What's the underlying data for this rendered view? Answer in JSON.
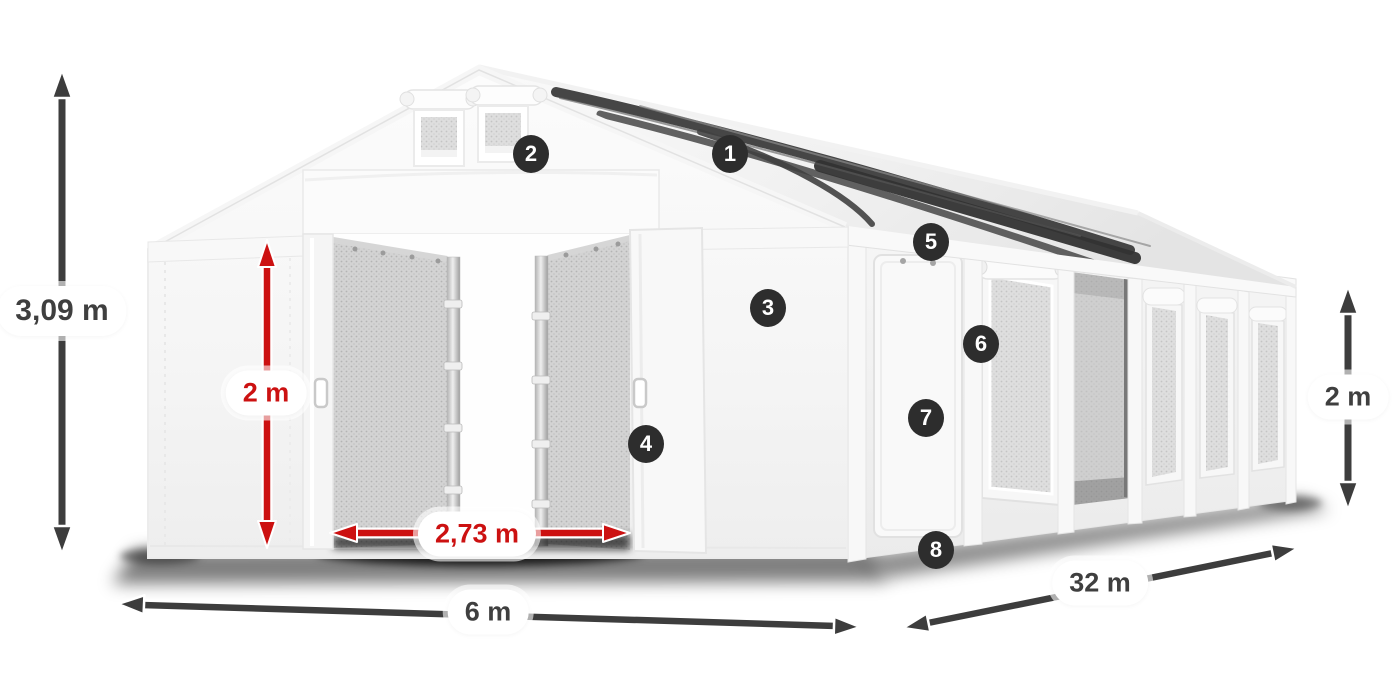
{
  "product_diagram": {
    "description": "tent-dimension-diagram",
    "dimensions": {
      "total_height": "3,09 m",
      "door_height": "2 m",
      "door_width": "2,73 m",
      "front_width": "6 m",
      "side_length": "32 m",
      "wall_height": "2 m"
    },
    "callouts": {
      "c1": "1",
      "c2": "2",
      "c3": "3",
      "c4": "4",
      "c5": "5",
      "c6": "6",
      "c7": "7",
      "c8": "8"
    },
    "colors": {
      "dimension_red": "#cc1111",
      "dimension_dark": "#3d3d3d",
      "callout_bg": "#2d2d2d",
      "callout_text": "#ffffff",
      "label_bg": "#ffffff",
      "label_text": "#3f3f3f"
    }
  }
}
